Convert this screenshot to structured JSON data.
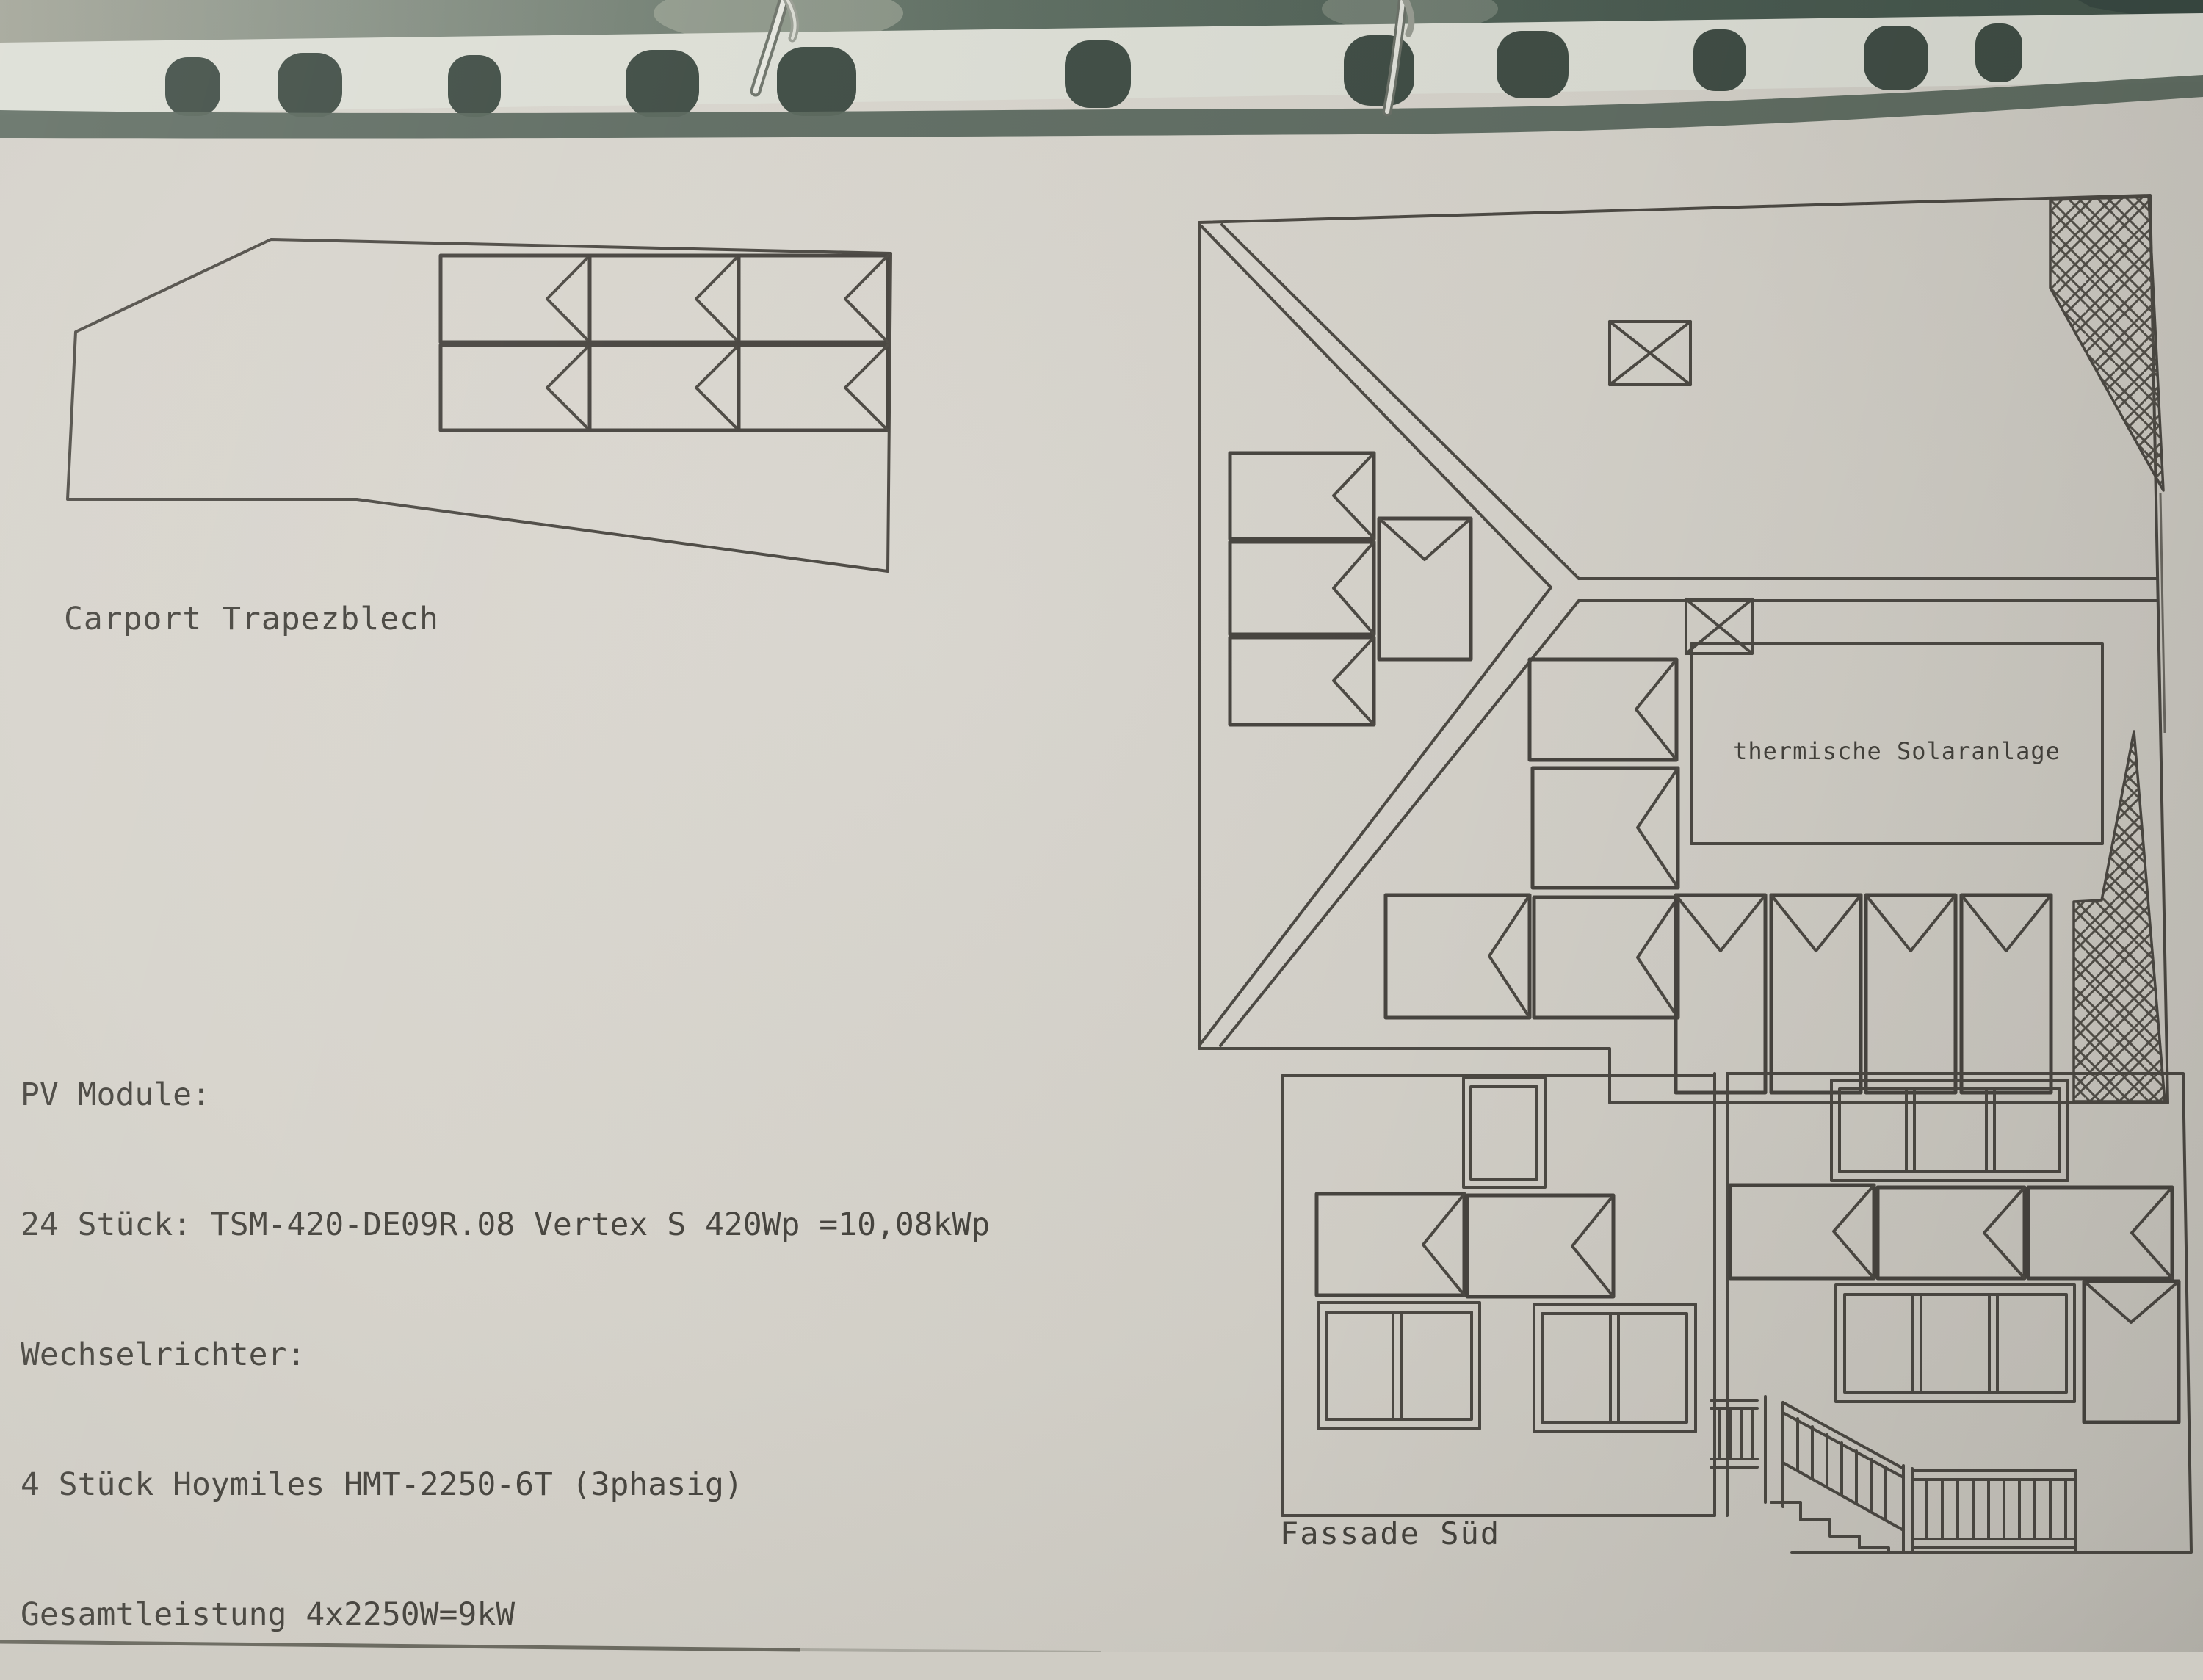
{
  "labels": {
    "carport": "Carport Trapezblech",
    "thermal": "thermische Solaranlage",
    "facade": "Fassade Süd"
  },
  "pv_info": {
    "lines": [
      "PV Module:",
      "24 Stück: TSM-420-DE09R.08 Vertex S 420Wp =10,08kWp",
      "Wechselrichter:",
      "4 Stück Hoymiles HMT-2250-6T (3phasig)",
      "Gesamtleistung 4x2250W=9kW"
    ]
  },
  "counts": {
    "carport_modules": 6,
    "roof_plan_modules": 12,
    "facade_modules": 6,
    "binder_holes": 11,
    "binder_rings": 2
  },
  "colors": {
    "paper": "#d6d3cb",
    "ink": "#4e4b45",
    "binder_green_dark": "#44554b",
    "binder_green_light": "#a2a497",
    "punched_strip": "#dcded5",
    "hole_dark": "#414e46",
    "shadow_band": "#5b685e",
    "ring_metal_light": "#e6e7e0",
    "ring_metal_dark": "#6f756c"
  }
}
